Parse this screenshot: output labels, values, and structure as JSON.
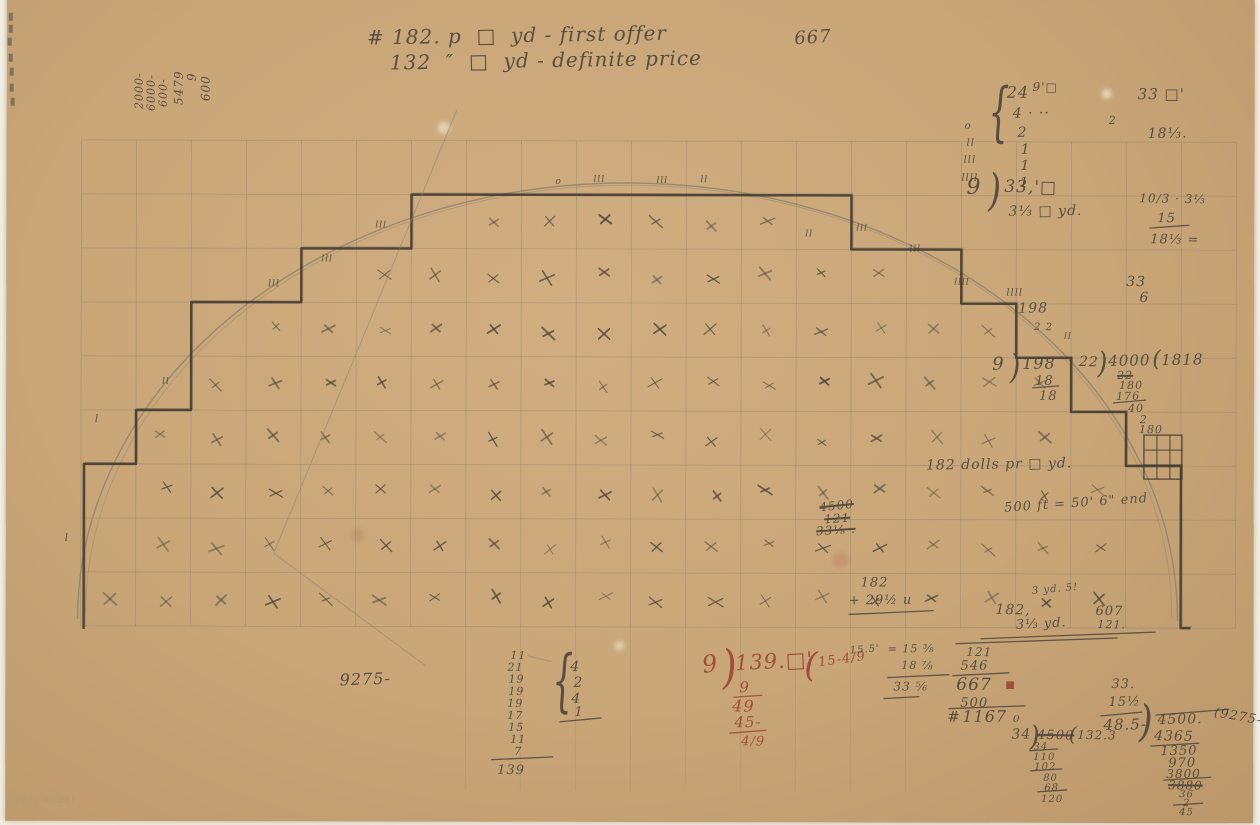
{
  "page": {
    "background": "#f2eee1",
    "paper_color": "#c8a678"
  },
  "figure": {
    "colors": {
      "pencil": "#4a4339",
      "pencil_dark": "#3f3930",
      "red": "#9c4334",
      "grid": "#91836a",
      "arc": "#8b7f6c",
      "faint": "#a3956f",
      "xmark": "#4e4637"
    },
    "grid": {
      "x0": 75,
      "col_w": 55,
      "cols": 21,
      "y0": 143,
      "row_h": 54,
      "rows": 9,
      "y_bottom": 629,
      "extended_cols": [
        7,
        8,
        9,
        10,
        11,
        12,
        13,
        14,
        15
      ],
      "y_extended": 793
    },
    "ellipse": {
      "cx": 622,
      "cy": 622,
      "rx": 550,
      "ry": 437
    },
    "xmark_region": {
      "cx": 622,
      "cy": 625,
      "rx": 538,
      "ry": 428,
      "limit": 0.95
    },
    "steps": {
      "start_x": 78,
      "end_x": 1185,
      "base_y": 632
    },
    "mini_grid": {
      "x": 1138,
      "y": 436,
      "w": 38,
      "h": 44
    },
    "diagonals": [
      [
        450,
        113,
        268,
        556
      ],
      [
        268,
        556,
        420,
        668
      ],
      [
        522,
        658,
        546,
        664
      ]
    ],
    "edge_marks": [
      [
        2,
        16
      ],
      [
        2,
        28
      ],
      [
        1,
        41
      ],
      [
        2,
        57
      ],
      [
        3,
        71
      ],
      [
        3,
        87
      ],
      [
        4,
        101
      ]
    ],
    "stains": [
      {
        "x": 835,
        "y": 562,
        "r": 8,
        "c": "rgba(190,110,100,.3)"
      },
      {
        "x": 437,
        "y": 130,
        "r": 6,
        "c": "rgba(255,246,230,.5)"
      },
      {
        "x": 1100,
        "y": 95,
        "r": 5,
        "c": "rgba(255,248,235,.55)"
      },
      {
        "x": 352,
        "y": 538,
        "r": 7,
        "c": "rgba(175,135,95,.4)"
      },
      {
        "x": 614,
        "y": 648,
        "r": 5,
        "c": "rgba(255,245,230,.45)"
      }
    ]
  },
  "lines": [
    {
      "x1": 1143,
      "y1": 229,
      "x2": 1183,
      "y2": 226
    },
    {
      "x1": 1026,
      "y1": 389,
      "x2": 1053,
      "y2": 387
    },
    {
      "x1": 1107,
      "y1": 404,
      "x2": 1140,
      "y2": 401
    },
    {
      "x1": 843,
      "y1": 616,
      "x2": 928,
      "y2": 612
    },
    {
      "x1": 975,
      "y1": 640,
      "x2": 1150,
      "y2": 633
    },
    {
      "x1": 728,
      "y1": 699,
      "x2": 757,
      "y2": 697,
      "c": "red"
    },
    {
      "x1": 724,
      "y1": 735,
      "x2": 761,
      "y2": 732,
      "c": "red"
    },
    {
      "x1": 882,
      "y1": 679,
      "x2": 944,
      "y2": 676
    },
    {
      "x1": 878,
      "y1": 700,
      "x2": 914,
      "y2": 698
    },
    {
      "x1": 950,
      "y1": 645,
      "x2": 1112,
      "y2": 639
    },
    {
      "x1": 947,
      "y1": 677,
      "x2": 1004,
      "y2": 674
    },
    {
      "x1": 943,
      "y1": 710,
      "x2": 1020,
      "y2": 707
    },
    {
      "x1": 1095,
      "y1": 717,
      "x2": 1137,
      "y2": 713
    },
    {
      "x1": 1150,
      "y1": 716,
      "x2": 1224,
      "y2": 710
    },
    {
      "x1": 1145,
      "y1": 747,
      "x2": 1194,
      "y2": 744
    },
    {
      "x1": 1158,
      "y1": 781,
      "x2": 1206,
      "y2": 778
    },
    {
      "x1": 1168,
      "y1": 806,
      "x2": 1198,
      "y2": 804
    },
    {
      "x1": 1024,
      "y1": 752,
      "x2": 1053,
      "y2": 750
    },
    {
      "x1": 1025,
      "y1": 772,
      "x2": 1057,
      "y2": 770
    },
    {
      "x1": 1032,
      "y1": 793,
      "x2": 1062,
      "y2": 791
    },
    {
      "x1": 486,
      "y1": 762,
      "x2": 548,
      "y2": 759
    },
    {
      "x1": 554,
      "y1": 724,
      "x2": 596,
      "y2": 720
    }
  ],
  "annotations": [
    {
      "n": "note-first-offer",
      "t": "# 182. p  □  yd - first offer",
      "x": 360,
      "y": 30,
      "s": 20,
      "r": -1
    },
    {
      "n": "note-667",
      "t": "667",
      "x": 787,
      "y": 32,
      "s": 18,
      "r": -4
    },
    {
      "n": "note-definite-price",
      "t": "132  ″  □  yd - definite price",
      "x": 383,
      "y": 55,
      "s": 20,
      "r": -1
    },
    {
      "t": "2000-",
      "x": 127,
      "y": 112,
      "s": 11,
      "r": -90
    },
    {
      "t": "6000-",
      "x": 139,
      "y": 114,
      "s": 11,
      "r": -90
    },
    {
      "t": "600-",
      "x": 151,
      "y": 110,
      "s": 11,
      "r": -90
    },
    {
      "t": "5479",
      "x": 166,
      "y": 108,
      "s": 12,
      "r": -90
    },
    {
      "t": "9",
      "x": 179,
      "y": 84,
      "s": 12,
      "r": -90
    },
    {
      "t": "600",
      "x": 193,
      "y": 104,
      "s": 12,
      "r": -90
    },
    {
      "t": "{",
      "x": 981,
      "y": 82,
      "s": 34,
      "sy": 1.9
    },
    {
      "t": "24",
      "x": 1000,
      "y": 86,
      "s": 16
    },
    {
      "t": "9'□",
      "x": 1026,
      "y": 82,
      "s": 12
    },
    {
      "t": "4 · ··",
      "x": 1006,
      "y": 108,
      "s": 14
    },
    {
      "t": "2",
      "x": 1011,
      "y": 127,
      "s": 14
    },
    {
      "t": "1",
      "x": 1014,
      "y": 144,
      "s": 14
    },
    {
      "t": "1",
      "x": 1014,
      "y": 160,
      "s": 14
    },
    {
      "t": "1",
      "x": 1013,
      "y": 177,
      "s": 14
    },
    {
      "t": "o",
      "x": 958,
      "y": 123,
      "s": 10
    },
    {
      "t": "ll",
      "x": 960,
      "y": 140,
      "s": 10
    },
    {
      "t": "lll",
      "x": 957,
      "y": 157,
      "s": 10
    },
    {
      "t": "llll",
      "x": 955,
      "y": 175,
      "s": 10
    },
    {
      "t": "9",
      "x": 960,
      "y": 178,
      "s": 22
    },
    {
      "t": ")",
      "x": 981,
      "y": 170,
      "s": 34,
      "sy": 1.3
    },
    {
      "t": "33,'□",
      "x": 998,
      "y": 180,
      "s": 17
    },
    {
      "t": "3⅓ □ yd.",
      "x": 1002,
      "y": 206,
      "s": 14
    },
    {
      "t": "33 □'",
      "x": 1131,
      "y": 88,
      "s": 15
    },
    {
      "t": "2",
      "x": 1102,
      "y": 116,
      "s": 11
    },
    {
      "t": "18⅓.",
      "x": 1141,
      "y": 128,
      "s": 14
    },
    {
      "t": "10/3 · 3⅓",
      "x": 1133,
      "y": 193,
      "s": 12
    },
    {
      "t": "15",
      "x": 1151,
      "y": 213,
      "s": 13
    },
    {
      "t": "18⅓ =",
      "x": 1144,
      "y": 234,
      "s": 13
    },
    {
      "t": "33",
      "x": 1120,
      "y": 276,
      "s": 14
    },
    {
      "t": "6",
      "x": 1133,
      "y": 292,
      "s": 14
    },
    {
      "t": "llll",
      "x": 1000,
      "y": 290,
      "s": 10
    },
    {
      "t": "198",
      "x": 1012,
      "y": 303,
      "s": 14
    },
    {
      "t": "2 2",
      "x": 1028,
      "y": 324,
      "s": 10
    },
    {
      "t": "9",
      "x": 986,
      "y": 357,
      "s": 18
    },
    {
      "t": ")",
      "x": 1003,
      "y": 352,
      "s": 28,
      "sy": 1.2
    },
    {
      "t": "198",
      "x": 1016,
      "y": 357,
      "s": 16
    },
    {
      "t": "18",
      "x": 1029,
      "y": 376,
      "s": 13
    },
    {
      "t": "18",
      "x": 1033,
      "y": 391,
      "s": 13
    },
    {
      "t": "22",
      "x": 1073,
      "y": 356,
      "s": 14
    },
    {
      "t": ")",
      "x": 1091,
      "y": 350,
      "s": 26,
      "sy": 1.15
    },
    {
      "t": "4000",
      "x": 1102,
      "y": 355,
      "s": 15
    },
    {
      "t": "(",
      "x": 1146,
      "y": 350,
      "s": 22
    },
    {
      "t": "1818",
      "x": 1155,
      "y": 354,
      "s": 15
    },
    {
      "t": "22",
      "x": 1111,
      "y": 371,
      "s": 11,
      "k": 1
    },
    {
      "t": "180",
      "x": 1113,
      "y": 381,
      "s": 11
    },
    {
      "t": "176",
      "x": 1110,
      "y": 392,
      "s": 11
    },
    {
      "t": "40",
      "x": 1122,
      "y": 404,
      "s": 11
    },
    {
      "t": "2",
      "x": 1134,
      "y": 415,
      "s": 11
    },
    {
      "t": "180",
      "x": 1133,
      "y": 425,
      "s": 11
    },
    {
      "n": "note-dollars-per-yd",
      "t": "182 dolls pr □ yd.",
      "x": 920,
      "y": 460,
      "s": 14,
      "r": -1
    },
    {
      "n": "note-500ft",
      "t": "500 ft = 50' 6\" end",
      "x": 998,
      "y": 503,
      "s": 13,
      "r": -4
    },
    {
      "t": "4500",
      "x": 813,
      "y": 503,
      "s": 12,
      "k": 1,
      "r": -6
    },
    {
      "t": "121",
      "x": 818,
      "y": 515,
      "s": 12,
      "k": 1,
      "r": -4
    },
    {
      "t": "33⅛ .",
      "x": 810,
      "y": 527,
      "s": 12,
      "k": 1,
      "r": -4
    },
    {
      "t": "182",
      "x": 855,
      "y": 578,
      "s": 13
    },
    {
      "t": "+ 29½ u",
      "x": 843,
      "y": 596,
      "s": 13
    },
    {
      "t": "3 yd. 5!",
      "x": 1026,
      "y": 588,
      "s": 10,
      "r": -5
    },
    {
      "t": "182,",
      "x": 990,
      "y": 604,
      "s": 14
    },
    {
      "t": "607",
      "x": 1090,
      "y": 606,
      "s": 13
    },
    {
      "t": "121.",
      "x": 1092,
      "y": 620,
      "s": 11
    },
    {
      "t": "3⅓ yd.",
      "x": 1010,
      "y": 620,
      "s": 13,
      "r": -3
    },
    {
      "n": "note-139-division",
      "t": "9",
      "x": 695,
      "y": 655,
      "s": 24,
      "c": "red",
      "r": -8
    },
    {
      "t": ")",
      "x": 714,
      "y": 647,
      "s": 40,
      "sy": 1.15,
      "c": "red",
      "r": -5
    },
    {
      "t": "139.□'",
      "x": 729,
      "y": 655,
      "s": 21,
      "c": "red",
      "r": -3
    },
    {
      "t": "(",
      "x": 799,
      "y": 650,
      "s": 34,
      "c": "red"
    },
    {
      "t": "15-4/9",
      "x": 812,
      "y": 658,
      "s": 13,
      "c": "red",
      "r": -8
    },
    {
      "t": "9",
      "x": 734,
      "y": 682,
      "s": 15,
      "c": "red"
    },
    {
      "t": "49",
      "x": 727,
      "y": 700,
      "s": 16,
      "c": "red"
    },
    {
      "t": "45-",
      "x": 729,
      "y": 717,
      "s": 15,
      "c": "red"
    },
    {
      "t": "4/9",
      "x": 736,
      "y": 737,
      "s": 13,
      "c": "red"
    },
    {
      "t": "15.5'",
      "x": 844,
      "y": 648,
      "s": 10,
      "r": -4
    },
    {
      "t": "= 15 ⅜",
      "x": 882,
      "y": 645,
      "s": 11
    },
    {
      "t": "18 ⅞",
      "x": 896,
      "y": 661,
      "s": 11
    },
    {
      "t": "33 ⅚",
      "x": 888,
      "y": 682,
      "s": 12
    },
    {
      "t": "121",
      "x": 961,
      "y": 647,
      "s": 12
    },
    {
      "t": "546",
      "x": 955,
      "y": 661,
      "s": 13
    },
    {
      "t": "667",
      "x": 951,
      "y": 678,
      "s": 17
    },
    {
      "t": "■",
      "x": 1000,
      "y": 682,
      "s": 10,
      "c": "red"
    },
    {
      "t": "500",
      "x": 955,
      "y": 698,
      "s": 13
    },
    {
      "t": "#",
      "x": 942,
      "y": 711,
      "s": 15
    },
    {
      "t": "1167 ₀",
      "x": 957,
      "y": 710,
      "s": 16
    },
    {
      "t": "33.",
      "x": 1106,
      "y": 679,
      "s": 13
    },
    {
      "t": "15½",
      "x": 1103,
      "y": 697,
      "s": 13
    },
    {
      "t": "48.5-",
      "x": 1098,
      "y": 719,
      "s": 15
    },
    {
      "t": ")",
      "x": 1133,
      "y": 702,
      "s": 36,
      "sy": 1.2
    },
    {
      "t": "4500.",
      "x": 1152,
      "y": 714,
      "s": 14
    },
    {
      "t": "4365",
      "x": 1149,
      "y": 730,
      "s": 14
    },
    {
      "t": "1350",
      "x": 1155,
      "y": 746,
      "s": 13
    },
    {
      "t": "970",
      "x": 1163,
      "y": 758,
      "s": 13
    },
    {
      "t": "3800",
      "x": 1161,
      "y": 769,
      "s": 12
    },
    {
      "t": "3880",
      "x": 1163,
      "y": 780,
      "s": 12,
      "k": 1
    },
    {
      "t": "36",
      "x": 1174,
      "y": 791,
      "s": 10
    },
    {
      "t": "2",
      "x": 1178,
      "y": 800,
      "s": 10
    },
    {
      "t": "45",
      "x": 1174,
      "y": 809,
      "s": 10
    },
    {
      "t": "(9275-",
      "x": 1210,
      "y": 707,
      "s": 13,
      "r": 10
    },
    {
      "t": "34",
      "x": 1006,
      "y": 729,
      "s": 14
    },
    {
      "t": ")",
      "x": 1024,
      "y": 724,
      "s": 26,
      "sy": 1.1
    },
    {
      "t": "4500",
      "x": 1032,
      "y": 730,
      "s": 13,
      "k": 1
    },
    {
      "t": "(",
      "x": 1064,
      "y": 725,
      "s": 20
    },
    {
      "t": "132.3",
      "x": 1072,
      "y": 730,
      "s": 12
    },
    {
      "t": "34",
      "x": 1028,
      "y": 744,
      "s": 10
    },
    {
      "t": "110",
      "x": 1028,
      "y": 754,
      "s": 10
    },
    {
      "t": "102",
      "x": 1029,
      "y": 764,
      "s": 10
    },
    {
      "t": "80",
      "x": 1038,
      "y": 775,
      "s": 10
    },
    {
      "t": "68",
      "x": 1039,
      "y": 785,
      "s": 10
    },
    {
      "t": "120",
      "x": 1036,
      "y": 796,
      "s": 10
    },
    {
      "n": "note-9275",
      "t": "9275-",
      "x": 334,
      "y": 675,
      "s": 16,
      "r": -2
    },
    {
      "t": "11",
      "x": 505,
      "y": 652,
      "s": 11
    },
    {
      "t": "21",
      "x": 502,
      "y": 664,
      "s": 11
    },
    {
      "t": "19",
      "x": 503,
      "y": 676,
      "s": 11
    },
    {
      "t": "19",
      "x": 503,
      "y": 688,
      "s": 11
    },
    {
      "t": "19",
      "x": 502,
      "y": 700,
      "s": 11
    },
    {
      "t": "17",
      "x": 502,
      "y": 712,
      "s": 11
    },
    {
      "t": "15",
      "x": 503,
      "y": 724,
      "s": 11
    },
    {
      "t": "11",
      "x": 505,
      "y": 736,
      "s": 11
    },
    {
      "t": "7",
      "x": 509,
      "y": 748,
      "s": 11
    },
    {
      "t": "139",
      "x": 492,
      "y": 766,
      "s": 13
    },
    {
      "t": "{",
      "x": 546,
      "y": 650,
      "s": 34,
      "sy": 2.0
    },
    {
      "t": "4",
      "x": 565,
      "y": 662,
      "s": 14
    },
    {
      "t": "2",
      "x": 568,
      "y": 678,
      "s": 14
    },
    {
      "t": "4",
      "x": 566,
      "y": 694,
      "s": 14
    },
    {
      "t": "1",
      "x": 569,
      "y": 708,
      "s": 13
    },
    {
      "t": "o",
      "x": 549,
      "y": 180,
      "s": 9
    },
    {
      "t": "lll",
      "x": 587,
      "y": 178,
      "s": 9
    },
    {
      "t": "lll",
      "x": 650,
      "y": 179,
      "s": 9
    },
    {
      "t": "ll",
      "x": 694,
      "y": 178,
      "s": 9
    },
    {
      "t": "ll",
      "x": 799,
      "y": 232,
      "s": 9
    },
    {
      "t": "lll",
      "x": 850,
      "y": 226,
      "s": 9
    },
    {
      "t": "lll",
      "x": 903,
      "y": 247,
      "s": 9
    },
    {
      "t": "llll",
      "x": 948,
      "y": 280,
      "s": 9
    },
    {
      "t": "lll",
      "x": 262,
      "y": 283,
      "s": 9
    },
    {
      "t": "lll",
      "x": 315,
      "y": 258,
      "s": 9
    },
    {
      "t": "lll",
      "x": 369,
      "y": 224,
      "s": 9
    },
    {
      "t": "ll",
      "x": 156,
      "y": 381,
      "s": 9
    },
    {
      "t": "l",
      "x": 89,
      "y": 418,
      "s": 10
    },
    {
      "t": "l",
      "x": 59,
      "y": 537,
      "s": 10
    },
    {
      "t": "ll",
      "x": 1058,
      "y": 334,
      "s": 9
    },
    {
      "n": "accession-number",
      "t": "1945.50.261",
      "x": 10,
      "y": 799,
      "s": 8,
      "c": "faint"
    }
  ]
}
